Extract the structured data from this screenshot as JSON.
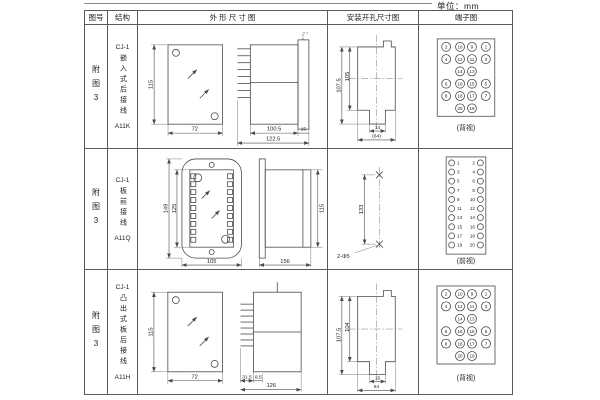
{
  "page": {
    "unit_label": "单位：mm"
  },
  "table": {
    "headers": [
      "图号",
      "结构",
      "外 形 尺 寸 图",
      "安装开孔尺寸图",
      "端子图"
    ],
    "rows": [
      {
        "figure_no": "附图3",
        "series": "CJ-1",
        "structure": "嵌入式后接线",
        "model": "A11K",
        "outline": {
          "front_height": "115",
          "front_width": "72",
          "body_depth": "100.5",
          "flange_depth": "15",
          "overall_depth": "122.5"
        },
        "install": {
          "outer_height": "107.5",
          "inner_height": "105",
          "notch_width": "14",
          "opening_width": "(64)"
        },
        "terminal": {
          "view_label": "(背视)",
          "grid": [
            [
              "2",
              "10",
              "9",
              "1"
            ],
            [
              "4",
              "12",
              "11",
              "3"
            ],
            [
              "",
              "14",
              "13",
              ""
            ],
            [
              "6",
              "16",
              "15",
              "5"
            ],
            [
              "8",
              "18",
              "17",
              "7"
            ],
            [
              "",
              "20",
              "19",
              ""
            ]
          ]
        }
      },
      {
        "figure_no": "附图3",
        "series": "CJ-1",
        "structure": "板前接线",
        "model": "A11Q",
        "outline": {
          "plate_height": "149",
          "window_height": "125",
          "plate_width": "105",
          "side_depth": "156",
          "side_height": "115"
        },
        "install": {
          "hole_spacing": "133",
          "hole_spec": "2-Φ5"
        },
        "terminal": {
          "view_label": "(前视)",
          "pairs": [
            [
              "1",
              "2"
            ],
            [
              "3",
              "4"
            ],
            [
              "5",
              "6"
            ],
            [
              "7",
              "8"
            ],
            [
              "9",
              "10"
            ],
            [
              "11",
              "12"
            ],
            [
              "13",
              "14"
            ],
            [
              "15",
              "16"
            ],
            [
              "17",
              "18"
            ],
            [
              "19",
              "20"
            ]
          ]
        }
      },
      {
        "figure_no": "附图3",
        "series": "CJ-1",
        "structure": "凸出式板后接线",
        "model": "A11H",
        "outline": {
          "front_height": "115",
          "front_width": "72",
          "pin_depth": "31.5",
          "step_depth": "9.5",
          "overall_depth": "126"
        },
        "install": {
          "outer_height": "107.5",
          "inner_height": "104",
          "notch_width": "16",
          "opening_width": "64"
        },
        "terminal": {
          "view_label": "(背视)",
          "grid": [
            [
              "2",
              "10",
              "9",
              "1"
            ],
            [
              "4",
              "12",
              "11",
              "3"
            ],
            [
              "",
              "14",
              "13",
              ""
            ],
            [
              "6",
              "16",
              "15",
              "5"
            ],
            [
              "8",
              "18",
              "17",
              "7"
            ],
            [
              "",
              "20",
              "19",
              ""
            ]
          ]
        }
      }
    ]
  }
}
